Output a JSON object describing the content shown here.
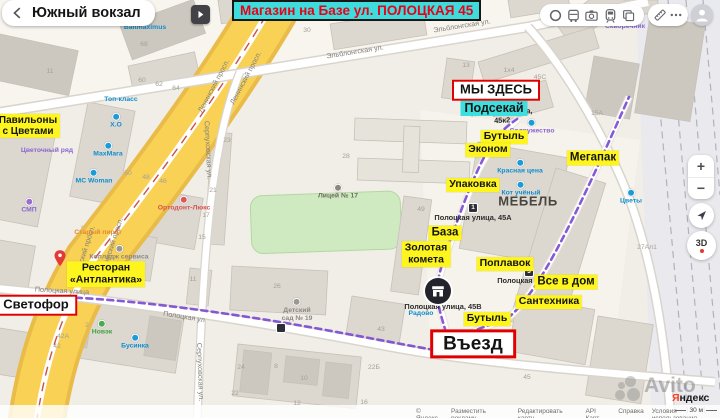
{
  "header": {
    "place_title": "Южный вокзал",
    "banner_title": "Магазин на Базе ул. ПОЛОЦКАЯ 45",
    "toolbar_icons": [
      "traffic-icon",
      "transit-icon",
      "panorama-icon",
      "train-icon",
      "layers-icon",
      "ruler-icon",
      "more-icon",
      "profile-avatar"
    ]
  },
  "controls": {
    "zoom_in": "+",
    "zoom_out": "−",
    "compass_label": "3D"
  },
  "footer": {
    "attribution": [
      "© Яндекс",
      "Разместить рекламу",
      "Редактировать карту",
      "API Карт",
      "Справка",
      "Условия использования"
    ],
    "scale_label": "30 м",
    "logo_ya": "Я",
    "logo_rest": "ндекс",
    "watermark": "Avito"
  },
  "colors": {
    "accent_red": "#e10000",
    "highlight_yellow": "#fdf51d",
    "highlight_cyan": "#3fdede",
    "banner_text_red": "#ea0016",
    "route_purple": "#7c4bd3",
    "road_yellow": "#f8d155",
    "poi_blue": "#1d9bd8"
  },
  "annotations": {
    "items": [
      {
        "kind": "red",
        "name": "marker-we-are-here",
        "text": "МЫ ЗДЕСЬ",
        "x": 496,
        "y": 90
      },
      {
        "kind": "red",
        "name": "marker-traffic-light",
        "text": "Светофор",
        "x": 36,
        "y": 305
      },
      {
        "kind": "red",
        "name": "marker-entrance",
        "cls": "big",
        "text": "Въезд",
        "x": 473,
        "y": 344
      },
      {
        "kind": "cyan",
        "name": "highlight-podsekay",
        "text": "Подсекай",
        "x": 494,
        "y": 108
      },
      {
        "kind": "yellow",
        "name": "highlight-pavilions",
        "lines": [
          "Павильоны",
          "с Цветами"
        ],
        "x": 28,
        "y": 126,
        "s": 10
      },
      {
        "kind": "yellow",
        "name": "highlight-restaurant",
        "lines": [
          "Ресторан",
          "«Антлантика»"
        ],
        "x": 106,
        "y": 274
      },
      {
        "kind": "yellow",
        "name": "highlight-butyl-1",
        "text": "Бутыль",
        "x": 504,
        "y": 137
      },
      {
        "kind": "yellow",
        "name": "highlight-ekonom",
        "text": "Эконом",
        "x": 488,
        "y": 150
      },
      {
        "kind": "yellow",
        "name": "highlight-megapak",
        "text": "Мегапак",
        "x": 593,
        "y": 158,
        "s": 11.5
      },
      {
        "kind": "yellow",
        "name": "highlight-upakovka",
        "text": "Упаковка",
        "x": 473,
        "y": 185
      },
      {
        "kind": "yellow",
        "name": "highlight-baza",
        "text": "База",
        "x": 445,
        "y": 233,
        "s": 11.5
      },
      {
        "kind": "yellow",
        "name": "highlight-zolotaya-kometa",
        "lines": [
          "Золотая",
          "комета"
        ],
        "x": 426,
        "y": 254
      },
      {
        "kind": "yellow",
        "name": "highlight-poplavok",
        "text": "Поплавок",
        "x": 505,
        "y": 264
      },
      {
        "kind": "yellow",
        "name": "highlight-vse-v-dom",
        "text": "Все в дом",
        "x": 566,
        "y": 282,
        "s": 11.5
      },
      {
        "kind": "yellow",
        "name": "highlight-santekhnika",
        "text": "Сантехника",
        "x": 549,
        "y": 302
      },
      {
        "kind": "yellow",
        "name": "highlight-butyl-2",
        "text": "Бутыль",
        "x": 487,
        "y": 319
      }
    ]
  },
  "map": {
    "labels": [
      {
        "kind": "street",
        "name": "street-label-elblongskaya",
        "text": "Эльблонгская ул.",
        "x": 355,
        "y": 52,
        "rot": -9
      },
      {
        "kind": "street",
        "name": "street-label-elblongskaya",
        "text": "Эльблонгская ул.",
        "x": 462,
        "y": 26,
        "rot": -9
      },
      {
        "kind": "street",
        "name": "street-label-leninsky",
        "text": "Ленинский просп.",
        "x": 214,
        "y": 86,
        "rot": -62
      },
      {
        "kind": "street",
        "name": "street-label-leninsky",
        "text": "Ленинский просп.",
        "x": 246,
        "y": 78,
        "rot": -62
      },
      {
        "kind": "street",
        "name": "street-label-leninsky",
        "text": "Ленинский просп.",
        "x": 84,
        "y": 254,
        "rot": -72
      },
      {
        "kind": "street",
        "name": "street-label-leninsky",
        "text": "Ленинский просп.",
        "x": 112,
        "y": 246,
        "rot": -72
      },
      {
        "kind": "street",
        "name": "street-label-serpukhovskaya",
        "text": "Серпуховская ул.",
        "x": 208,
        "y": 150,
        "rot": 87
      },
      {
        "kind": "street",
        "name": "street-label-serpukhovskaya",
        "text": "Серпуховская ул.",
        "x": 200,
        "y": 372,
        "rot": 88
      },
      {
        "kind": "street",
        "name": "street-label-polotskaya",
        "text": "Полоцкая улица",
        "x": 62,
        "y": 291,
        "rot": 3
      },
      {
        "kind": "street",
        "name": "street-label-polotskaya",
        "text": "Полоцкая ул",
        "x": 184,
        "y": 317,
        "rot": 9
      },
      {
        "kind": "addr",
        "name": "address-45k2",
        "lines": [
          "Полоцкая улица,",
          "45к2"
        ],
        "x": 502,
        "y": 117,
        "rot": -3
      },
      {
        "kind": "addr",
        "name": "address-45a",
        "text": "Полоцкая улица, 45А",
        "x": 473,
        "y": 218
      },
      {
        "kind": "addr",
        "name": "address-45v",
        "text": "Полоцкая улица, 45В",
        "x": 443,
        "y": 307
      },
      {
        "kind": "addr",
        "name": "address-polotskaya-stop",
        "text": "Полоцкая у",
        "x": 518,
        "y": 281
      },
      {
        "kind": "landmark",
        "name": "landmark-mebel",
        "text": "МЕБЕЛЬ",
        "x": 528,
        "y": 202
      },
      {
        "kind": "poi",
        "name": "poi-baltmaximus",
        "text": "Baltmaximus",
        "x": 145,
        "y": 28,
        "color": "#0f8dcf",
        "inter": true
      },
      {
        "kind": "poi",
        "name": "poi-skvorechnik",
        "text": "Скворечник",
        "x": 625,
        "y": 27,
        "color": "#8a66cf",
        "inter": true
      },
      {
        "kind": "poi",
        "name": "poi-top-klass",
        "text": "Топ-класс",
        "x": 121,
        "y": 100,
        "color": "#0f8dcf",
        "inter": true
      },
      {
        "kind": "poi",
        "name": "poi-ho",
        "text": "Х.О",
        "x": 116,
        "y": 121,
        "color": "#0f8dcf",
        "icon": "#1d9bd8",
        "inter": true
      },
      {
        "kind": "poi",
        "name": "poi-makhmaga",
        "text": "МахМага",
        "x": 108,
        "y": 150,
        "color": "#0f8dcf",
        "icon": "#1d9bd8",
        "inter": true
      },
      {
        "kind": "poi",
        "name": "poi-mc-woman",
        "text": "MC Woman",
        "x": 94,
        "y": 177,
        "color": "#0f8dcf",
        "icon": "#1d9bd8",
        "inter": true
      },
      {
        "kind": "poi",
        "name": "poi-tsvetochny-ryad",
        "text": "Цветочный ряд",
        "x": 47,
        "y": 151,
        "color": "#8a66cf",
        "inter": true
      },
      {
        "kind": "poi",
        "name": "poi-smp",
        "text": "СМП",
        "x": 29,
        "y": 206,
        "color": "#8a66cf",
        "icon": "#9a6fd0",
        "inter": true
      },
      {
        "kind": "poi",
        "name": "poi-ortodont",
        "text": "Ортодонт-Люкс",
        "x": 184,
        "y": 204,
        "color": "#d65151",
        "icon": "#e05555",
        "inter": true
      },
      {
        "kind": "poi",
        "name": "poi-stary-pirat",
        "text": "Старый пират",
        "x": 98,
        "y": 233,
        "color": "#df8a33",
        "inter": true
      },
      {
        "kind": "poi",
        "name": "poi-college-servisa",
        "text": "Колледж сервиса",
        "x": 119,
        "y": 253,
        "color": "#8b8980",
        "icon": "#9b988f",
        "inter": true
      },
      {
        "kind": "poi",
        "name": "poi-novek",
        "text": "Новэк",
        "x": 102,
        "y": 328,
        "color": "#3aa23c",
        "icon": "#46ad49",
        "inter": true
      },
      {
        "kind": "poi",
        "name": "poi-businka",
        "text": "Бусинка",
        "x": 135,
        "y": 342,
        "color": "#0f8dcf",
        "icon": "#1d9bd8",
        "inter": true
      },
      {
        "kind": "poi",
        "name": "poi-radovo",
        "text": "Радово",
        "x": 421,
        "y": 314,
        "color": "#0f8dcf",
        "inter": true
      },
      {
        "kind": "poi",
        "name": "poi-sodruzhestvo",
        "text": "Содружество",
        "x": 532,
        "y": 127,
        "color": "#8a66cf",
        "icon": "#1d9bd8",
        "inter": true
      },
      {
        "kind": "poi",
        "name": "poi-krasnaya-tsena",
        "text": "Красная цена",
        "x": 520,
        "y": 167,
        "color": "#0f8dcf",
        "icon": "#1d9bd8",
        "inter": true
      },
      {
        "kind": "poi",
        "name": "poi-kot-ucheny",
        "text": "Кот учёный",
        "x": 521,
        "y": 189,
        "color": "#0f8dcf",
        "icon": "#1d9bd8",
        "inter": true
      },
      {
        "kind": "poi",
        "name": "poi-tsvety",
        "text": "Цветы",
        "x": 631,
        "y": 197,
        "color": "#0f8dcf",
        "icon": "#1d9bd8",
        "inter": true
      },
      {
        "kind": "poi",
        "name": "poi-litsey-17",
        "text": "Лицей № 17",
        "x": 338,
        "y": 192,
        "color": "#6d6a62",
        "icon": "#8a877e",
        "inter": true
      },
      {
        "kind": "poi",
        "name": "poi-detsky-sad-19",
        "lines": [
          "Детский",
          "сад № 19"
        ],
        "x": 297,
        "y": 310,
        "color": "#8b8980",
        "icon": "#9b988f",
        "inter": true
      },
      {
        "kind": "stop",
        "name": "transit-stop-1",
        "text": "1",
        "x": 473,
        "y": 208,
        "inter": true
      },
      {
        "kind": "stop",
        "name": "transit-stop-3",
        "text": "3",
        "x": 529,
        "y": 272,
        "inter": true
      },
      {
        "kind": "stop",
        "name": "transit-stop",
        "text": "",
        "x": 281,
        "y": 328,
        "inter": true
      },
      {
        "kind": "num",
        "text": "68",
        "x": 144,
        "y": 45
      },
      {
        "kind": "num",
        "text": "60",
        "x": 142,
        "y": 81
      },
      {
        "kind": "num",
        "text": "62",
        "x": 159,
        "y": 85
      },
      {
        "kind": "num",
        "text": "64",
        "x": 176,
        "y": 89
      },
      {
        "kind": "num",
        "text": "30",
        "x": 307,
        "y": 31
      },
      {
        "kind": "num",
        "text": "11",
        "x": 50,
        "y": 72
      },
      {
        "kind": "num",
        "text": "13",
        "x": 466,
        "y": 66
      },
      {
        "kind": "num",
        "text": "10",
        "x": 461,
        "y": 86
      },
      {
        "kind": "num",
        "text": "45С",
        "x": 540,
        "y": 78
      },
      {
        "kind": "num",
        "text": "1х4",
        "x": 509,
        "y": 71
      },
      {
        "kind": "num",
        "text": "15А",
        "x": 597,
        "y": 114
      },
      {
        "kind": "num",
        "text": "49",
        "x": 421,
        "y": 210
      },
      {
        "kind": "num",
        "text": "28",
        "x": 346,
        "y": 157
      },
      {
        "kind": "num",
        "text": "23",
        "x": 227,
        "y": 141
      },
      {
        "kind": "num",
        "text": "21",
        "x": 213,
        "y": 191
      },
      {
        "kind": "num",
        "text": "17",
        "x": 206,
        "y": 216
      },
      {
        "kind": "num",
        "text": "15",
        "x": 202,
        "y": 238
      },
      {
        "kind": "num",
        "text": "26",
        "x": 277,
        "y": 287
      },
      {
        "kind": "num",
        "text": "11",
        "x": 193,
        "y": 280
      },
      {
        "kind": "num",
        "text": "24",
        "x": 241,
        "y": 368
      },
      {
        "kind": "num",
        "text": "22",
        "x": 235,
        "y": 394
      },
      {
        "kind": "num",
        "text": "8",
        "x": 276,
        "y": 367
      },
      {
        "kind": "num",
        "text": "10",
        "x": 304,
        "y": 379
      },
      {
        "kind": "num",
        "text": "12",
        "x": 297,
        "y": 404
      },
      {
        "kind": "num",
        "text": "16",
        "x": 364,
        "y": 403
      },
      {
        "kind": "num",
        "text": "43",
        "x": 381,
        "y": 330
      },
      {
        "kind": "num",
        "text": "22Б",
        "x": 374,
        "y": 368
      },
      {
        "kind": "num",
        "text": "42Б",
        "x": 72,
        "y": 310
      },
      {
        "kind": "num",
        "text": "42А",
        "x": 63,
        "y": 337
      },
      {
        "kind": "num",
        "text": "42",
        "x": 57,
        "y": 347
      },
      {
        "kind": "num",
        "text": "2",
        "x": 87,
        "y": 326
      },
      {
        "kind": "num",
        "text": "45",
        "x": 527,
        "y": 378
      },
      {
        "kind": "num",
        "text": "27Ал1",
        "x": 647,
        "y": 248
      },
      {
        "kind": "num",
        "text": "50",
        "x": 128,
        "y": 174
      },
      {
        "kind": "num",
        "text": "48",
        "x": 146,
        "y": 178
      },
      {
        "kind": "num",
        "text": "46",
        "x": 163,
        "y": 182
      }
    ]
  }
}
